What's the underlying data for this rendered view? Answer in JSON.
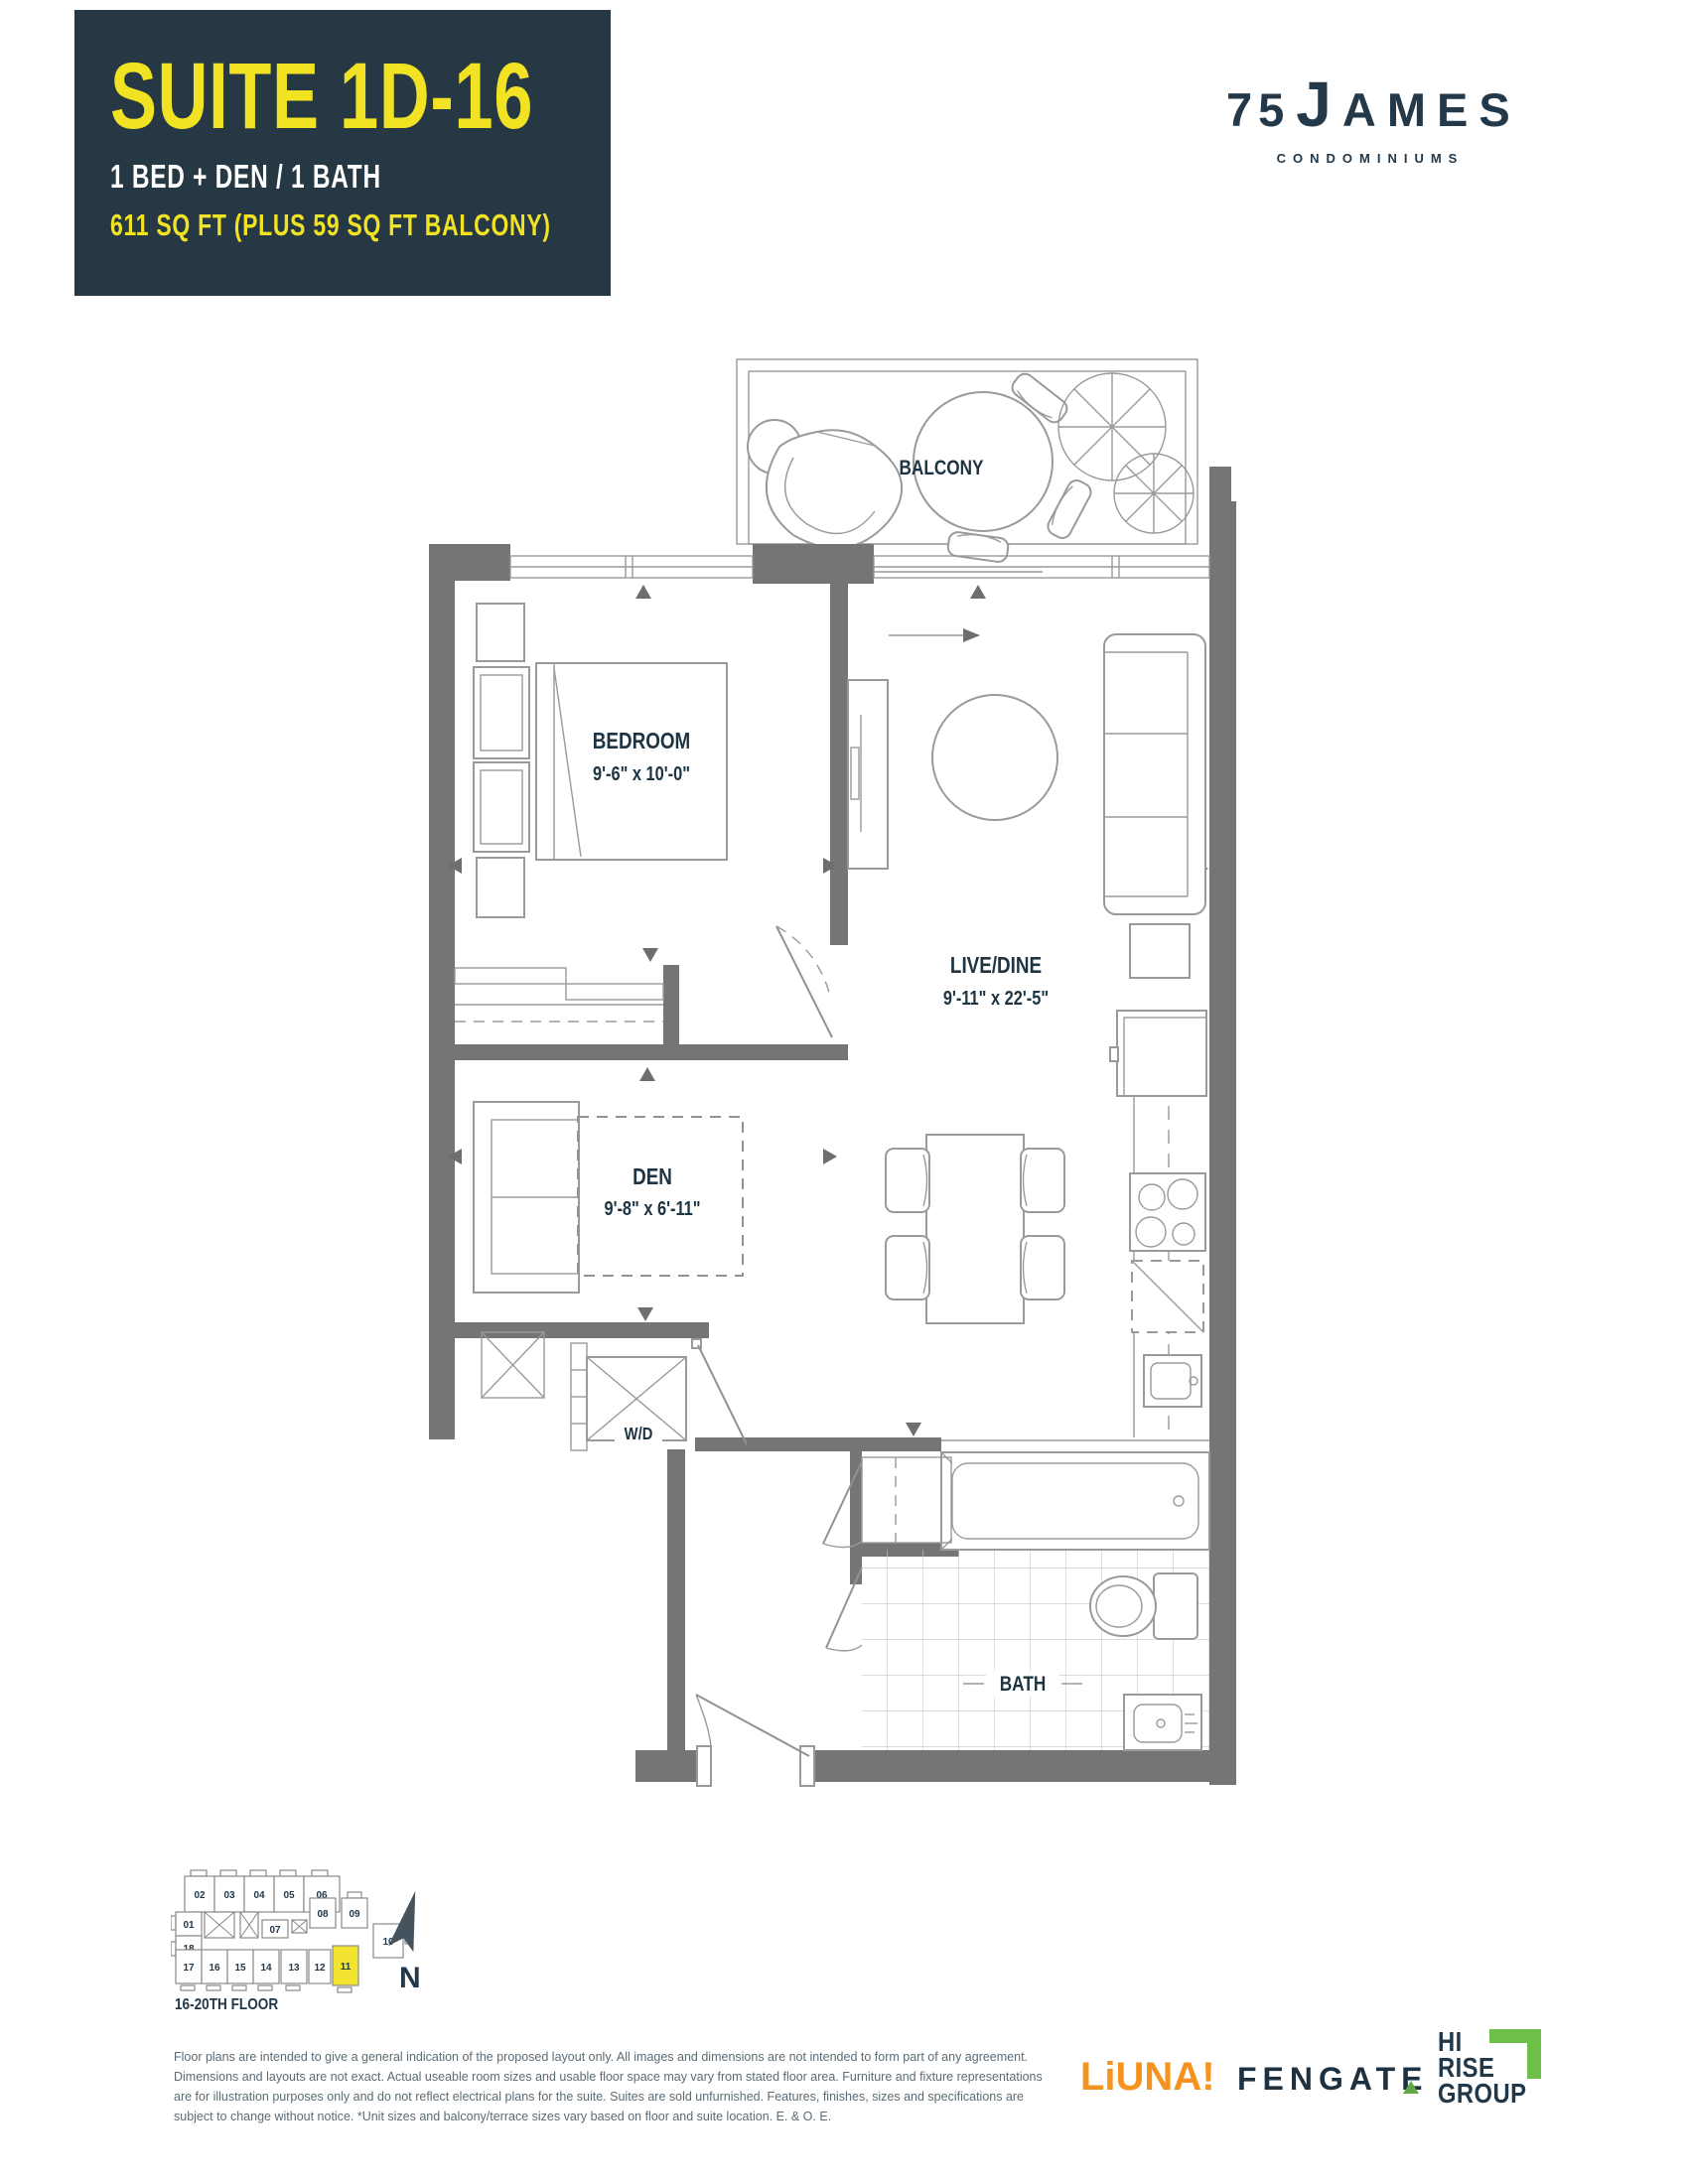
{
  "header": {
    "suite_name": "SUITE 1D-16",
    "configuration": "1 BED + DEN / 1 BATH",
    "area": "611 SQ FT (PLUS 59 SQ FT BALCONY)"
  },
  "brand": {
    "number": "75",
    "name": "JAMES",
    "tagline": "CONDOMINIUMS"
  },
  "plan": {
    "balcony": "BALCONY",
    "bedroom": "BEDROOM",
    "bedroom_dims": "9'-6\" x 10'-0\"",
    "live_dine": "LIVE/DINE",
    "live_dine_dims": "9'-11\" x 22'-5\"",
    "den": "DEN",
    "den_dims": "9'-8\" x 6'-11\"",
    "wd": "W/D",
    "bath": "BATH"
  },
  "keyplan": {
    "floor_label": "16-20TH FLOOR",
    "north_label": "N",
    "highlighted_unit": "11",
    "units": {
      "u01": "01",
      "u02": "02",
      "u03": "03",
      "u04": "04",
      "u05": "05",
      "u06": "06",
      "u07": "07",
      "u08": "08",
      "u09": "09",
      "u10": "10",
      "u11": "11",
      "u12": "12",
      "u13": "13",
      "u14": "14",
      "u15": "15",
      "u16": "16",
      "u17": "17",
      "u18": "18"
    }
  },
  "footer": {
    "line1": "Floor plans are intended to give a general indication of the proposed layout only. All images and dimensions are not intended to form part of any agreement.",
    "line2": "Dimensions and layouts are not exact. Actual useable room sizes and usable floor space may vary from stated floor area. Furniture and fixture representations",
    "line3": "are for illustration purposes only and do not reflect electrical plans for the suite. Suites are sold unfurnished. Features, finishes, sizes and specifications are",
    "line4": "subject to change without notice. *Unit sizes and balcony/terrace sizes vary based on floor and suite location. E. & O. E."
  },
  "logos": {
    "liuna": "LiUNA!",
    "fengate": "FENGATE",
    "hirise_line1": "HI",
    "hirise_line2": "RISE",
    "hirise_line3": "GROUP"
  },
  "colors": {
    "navy": "#253844",
    "yellow": "#F2E224",
    "wall_gray": "#757575",
    "line_gray": "#929292",
    "orange": "#F6921E",
    "green": "#6CBF47"
  }
}
